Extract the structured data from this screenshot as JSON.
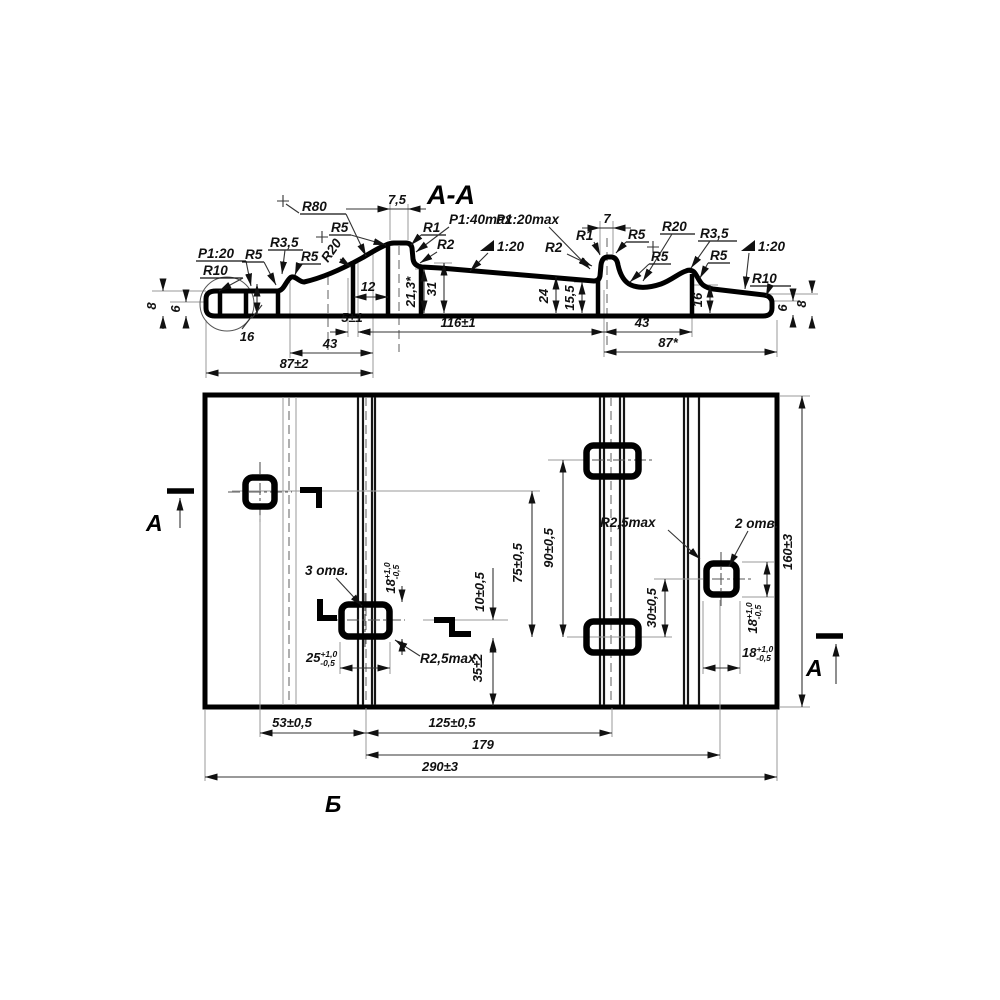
{
  "section": {
    "title": "А-А",
    "labels": {
      "taper_left": "Р1:20",
      "r10_left": "R10",
      "r5_left": "R5",
      "r3_5_left": "R3,5",
      "r5_bump_left": "R5",
      "r80": "R80",
      "r20_left": "R20",
      "r5_shoulder": "R5",
      "r1_left": "R1",
      "taper_1_40": "Р1:40max",
      "r2_left": "R2",
      "slope_mid": "1:20",
      "taper_mid": "Р1:20max",
      "r2_right": "R2",
      "r1_right": "R1",
      "r5_hump_right": "R5",
      "r20_right": "R20",
      "r5_dip_right": "R5",
      "r3_5_right": "R3,5",
      "r5_bump_right": "R5",
      "slope_right": "1:20",
      "r10_right": "R10"
    },
    "dims": {
      "h8_left": "8",
      "h6_left": "6",
      "v16_left": "16",
      "w12": "12",
      "w7_5": "7,5",
      "h21_3": "21,3*",
      "h31": "31",
      "w5": "5±1",
      "w116": "116±1",
      "w43_left": "43",
      "w87_left": "87±2",
      "w7": "7",
      "h24": "24",
      "h15_5": "15,5",
      "h16_right": "16",
      "h6_right": "6",
      "h8_right": "8",
      "w43_right": "43",
      "w87_right": "87*"
    }
  },
  "plan": {
    "notes": {
      "three_holes": "3 отв.",
      "two_holes": "2 отв.",
      "r_max": "R2,5max"
    },
    "dims": {
      "d18": "18",
      "d25": "25",
      "tol_plus": "+1,0",
      "tol_minus": "-0,5",
      "v10": "10±0,5",
      "v30": "30±0,5",
      "v35": "35±2",
      "v75": "75±0,5",
      "v90": "90±0,5",
      "v160": "160±3",
      "h53": "53±0,5",
      "h125": "125±0,5",
      "h179": "179",
      "h290": "290±3"
    }
  },
  "markers": {
    "cut_letter": "А",
    "view_letter": "Б"
  }
}
